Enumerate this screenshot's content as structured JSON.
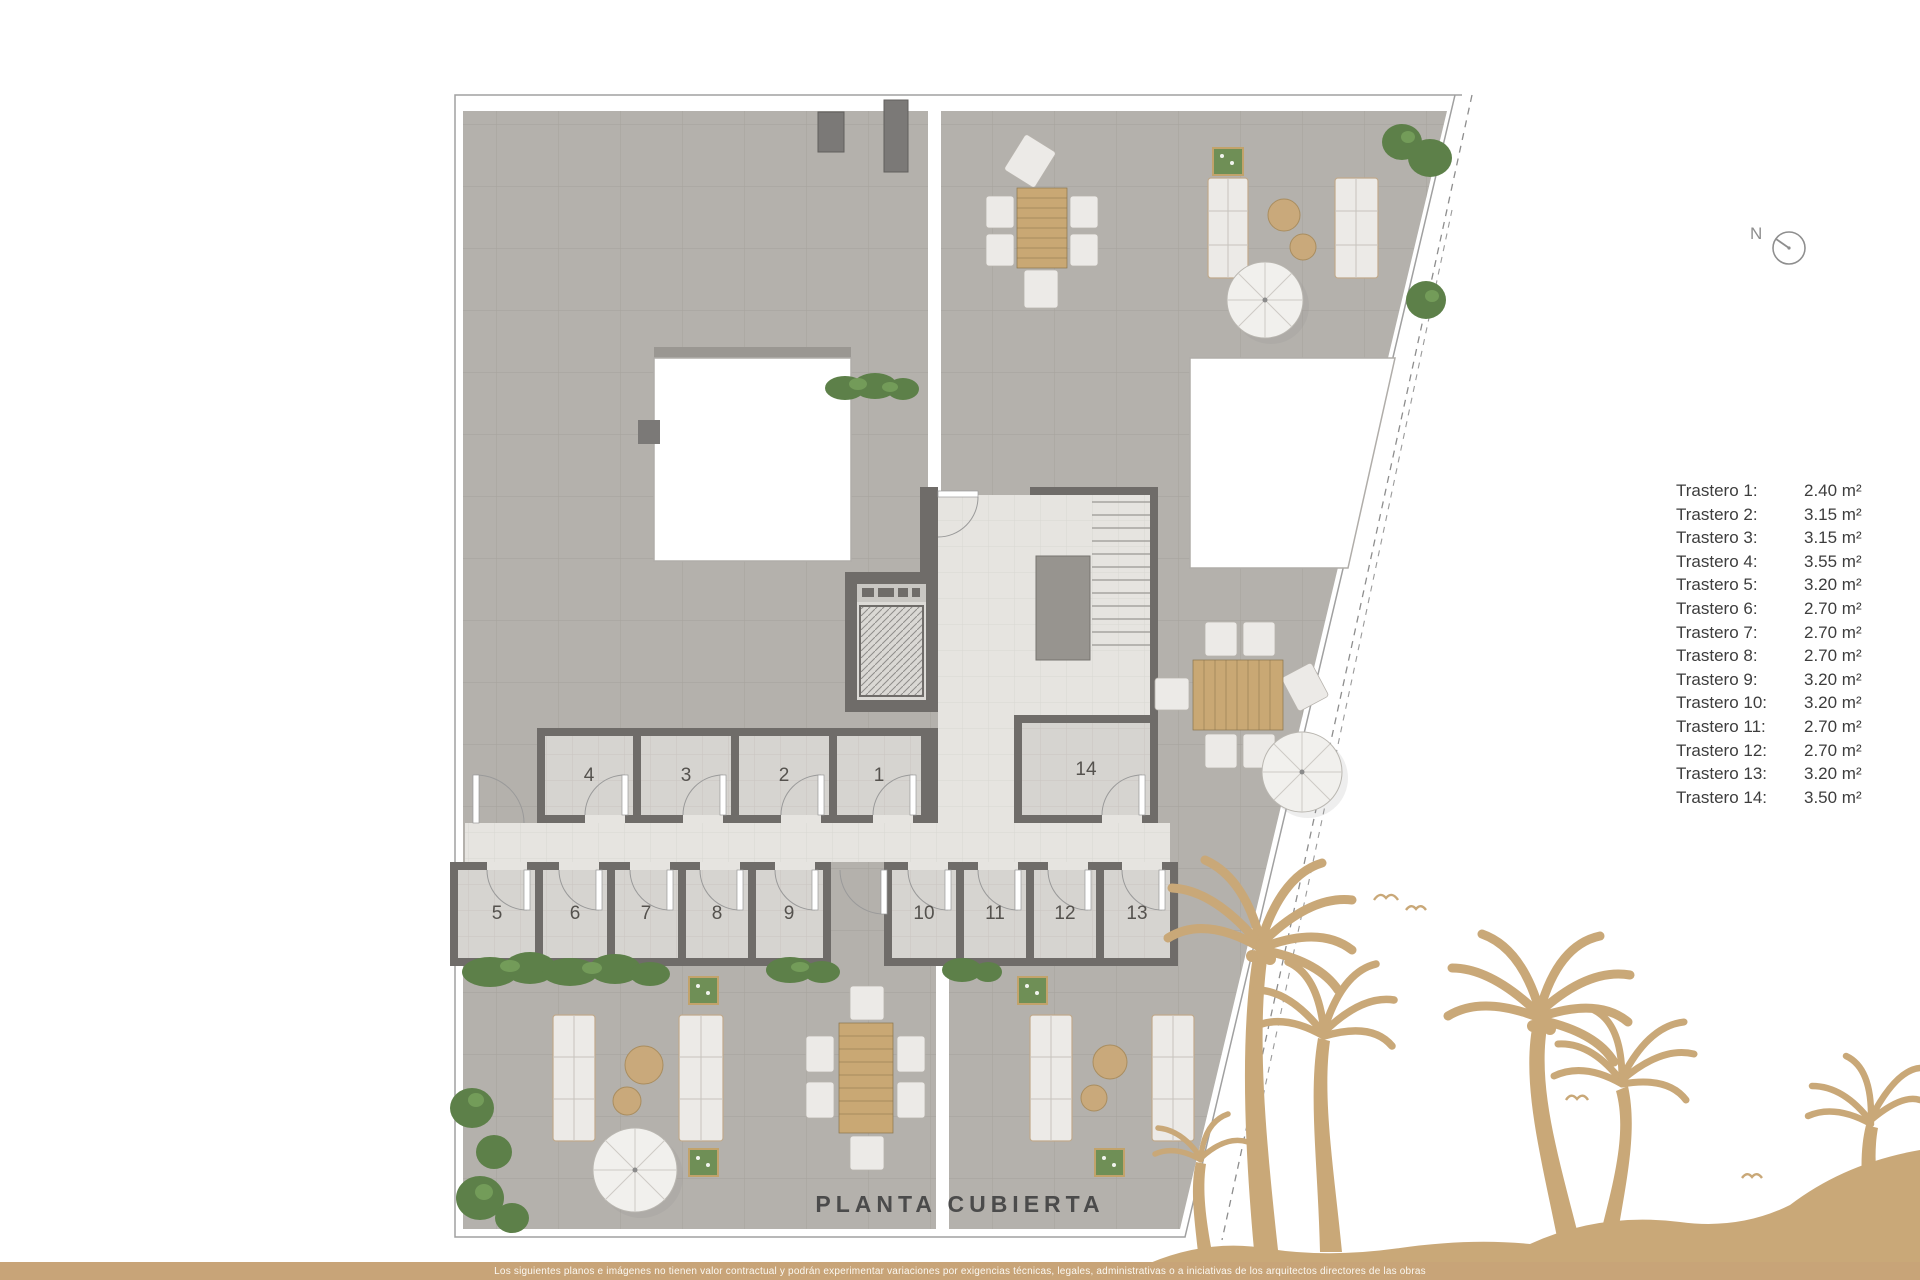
{
  "title": "PLANTA CUBIERTA",
  "compass": {
    "label": "N"
  },
  "legend": {
    "items": [
      {
        "label": "Trastero 1:",
        "area": "2.40 m²"
      },
      {
        "label": "Trastero 2:",
        "area": "3.15 m²"
      },
      {
        "label": "Trastero 3:",
        "area": "3.15 m²"
      },
      {
        "label": "Trastero 4:",
        "area": "3.55 m²"
      },
      {
        "label": "Trastero 5:",
        "area": "3.20 m²"
      },
      {
        "label": "Trastero 6:",
        "area": "2.70 m²"
      },
      {
        "label": "Trastero 7:",
        "area": "2.70 m²"
      },
      {
        "label": "Trastero 8:",
        "area": "2.70 m²"
      },
      {
        "label": "Trastero 9:",
        "area": "3.20 m²"
      },
      {
        "label": "Trastero 10:",
        "area": "3.20 m²"
      },
      {
        "label": "Trastero 11:",
        "area": "2.70 m²"
      },
      {
        "label": "Trastero 12:",
        "area": "2.70 m²"
      },
      {
        "label": "Trastero 13:",
        "area": "3.20 m²"
      },
      {
        "label": "Trastero 14:",
        "area": "3.50 m²"
      }
    ]
  },
  "plan": {
    "rooms": [
      {
        "number": "1"
      },
      {
        "number": "2"
      },
      {
        "number": "3"
      },
      {
        "number": "4"
      },
      {
        "number": "5"
      },
      {
        "number": "6"
      },
      {
        "number": "7"
      },
      {
        "number": "8"
      },
      {
        "number": "9"
      },
      {
        "number": "10"
      },
      {
        "number": "11"
      },
      {
        "number": "12"
      },
      {
        "number": "13"
      },
      {
        "number": "14"
      }
    ]
  },
  "footer": {
    "disclaimer": "Los siguientes planos e imágenes no tienen valor contractual y podrán experimentar variaciones por exigencias técnicas, legales, administrativas o a iniciativas de los arquitectos directores de las obras"
  },
  "colors": {
    "accent_gold": "#c8a478",
    "wall_gray": "#6f6c69",
    "terrace_gray": "#b4b1ac"
  }
}
